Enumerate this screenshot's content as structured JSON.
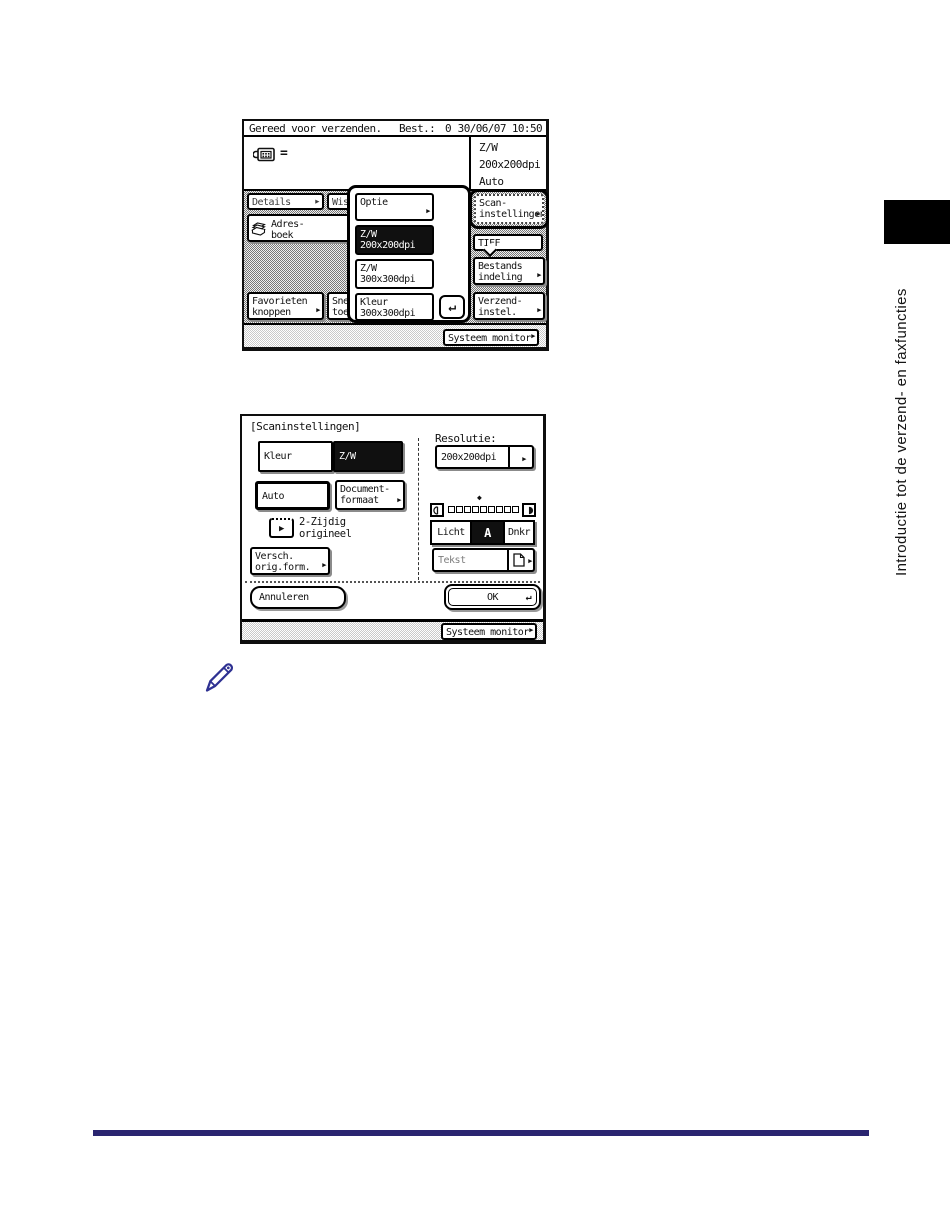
{
  "page": {
    "sidebar_text": "Introductie tot de verzend- en faxfuncties"
  },
  "icons": {
    "right_arrow": "▶",
    "enter": "↵",
    "diamond": "◆"
  },
  "screen1": {
    "status_ready": "Gereed voor verzenden.",
    "status_dest_label": "Best.:",
    "status_dest_value": "0",
    "status_datetime": "30/06/07 10:50",
    "fax_symbol": "=",
    "info_mode": "Z/W",
    "info_resolution": "200x200dpi",
    "info_exposure": "Auto",
    "details_label": "Details",
    "wissen_label": "Wiss",
    "adresboek_line1": "Adres-",
    "adresboek_line2": "boek",
    "favorieten_line1": "Favorieten",
    "favorieten_line2": "knoppen",
    "snelkies_line1": "Snelki",
    "snelkies_line2": "toets",
    "scaninstellingen_line1": "Scan-",
    "scaninstellingen_line2": "instellingen",
    "tiff_label": "TIFF",
    "bestands_line1": "Bestands",
    "bestands_line2": "indeling",
    "verzend_line1": "Verzend-",
    "verzend_line2": "instel.",
    "systeem_monitor": "Systeem monitor",
    "popup": {
      "optie": "Optie",
      "items": [
        {
          "line1": "Z/W",
          "line2": "200x200dpi"
        },
        {
          "line1": "Z/W",
          "line2": "300x300dpi"
        },
        {
          "line1": "Kleur",
          "line2": "300x300dpi"
        }
      ]
    }
  },
  "screen2": {
    "title": "[Scaninstellingen]",
    "kleur": "Kleur",
    "zw": "Z/W",
    "auto": "Auto",
    "documentformaat_line1": "Document-",
    "documentformaat_line2": "formaat",
    "tweezijdig_line1": "2-Zijdig",
    "tweezijdig_line2": "origineel",
    "versch_line1": "Versch.",
    "versch_line2": "orig.form.",
    "resolutie_label": "Resolutie:",
    "resolutie_value": "200x200dpi",
    "licht": "Licht",
    "exposure_auto": "A",
    "dnkr": "Dnkr",
    "tekst": "Tekst",
    "annuleren": "Annuleren",
    "ok": "OK",
    "systeem_monitor": "Systeem monitor"
  }
}
